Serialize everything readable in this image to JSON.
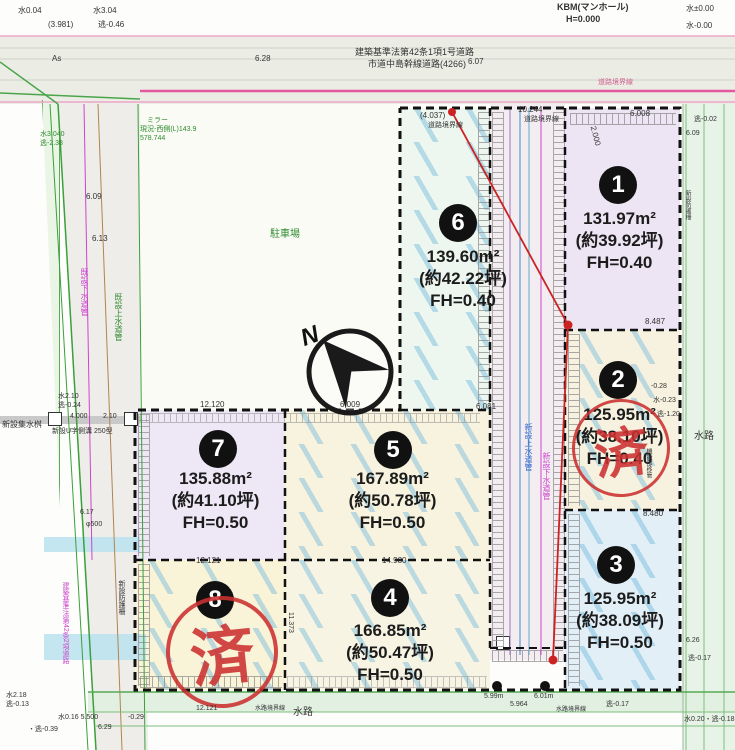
{
  "labels": {
    "north": "N",
    "sold_stamp": "済"
  },
  "plots": [
    {
      "no": "1",
      "area": "131.97m²",
      "tsubo": "(約39.92坪)",
      "fh": "FH=0.40",
      "sold": false
    },
    {
      "no": "2",
      "area": "125.95m²",
      "tsubo": "(約38.10坪)",
      "fh": "FH=0.40",
      "sold": true
    },
    {
      "no": "3",
      "area": "125.95m²",
      "tsubo": "(約38.09坪)",
      "fh": "FH=0.50",
      "sold": false
    },
    {
      "no": "4",
      "area": "166.85m²",
      "tsubo": "(約50.47坪)",
      "fh": "FH=0.50",
      "sold": false
    },
    {
      "no": "5",
      "area": "167.89m²",
      "tsubo": "(約50.78坪)",
      "fh": "FH=0.50",
      "sold": false
    },
    {
      "no": "6",
      "area": "139.60m²",
      "tsubo": "(約42.22坪)",
      "fh": "FH=0.40",
      "sold": false
    },
    {
      "no": "7",
      "area": "135.88m²",
      "tsubo": "(約41.10坪)",
      "fh": "FH=0.50",
      "sold": false
    },
    {
      "no": "8",
      "area": "",
      "tsubo": "",
      "fh": "",
      "sold": true
    }
  ],
  "annotations": [
    {
      "x": 18,
      "y": 7,
      "t": "水0.04"
    },
    {
      "x": 93,
      "y": 7,
      "t": "水3.04"
    },
    {
      "x": 48,
      "y": 21,
      "t": "(3.981)"
    },
    {
      "x": 98,
      "y": 21,
      "t": "逃-0.46"
    },
    {
      "x": 557,
      "y": 3,
      "t": "KBM(マンホール)",
      "s": 9,
      "b": 1
    },
    {
      "x": 566,
      "y": 15,
      "t": "H=0.000",
      "s": 9,
      "b": 1
    },
    {
      "x": 686,
      "y": 5,
      "t": "水±0.00"
    },
    {
      "x": 686,
      "y": 22,
      "t": "水-0.00"
    },
    {
      "x": 52,
      "y": 55,
      "t": "As"
    },
    {
      "x": 255,
      "y": 55,
      "t": "6.28"
    },
    {
      "x": 355,
      "y": 48,
      "t": "建築基準法第42条1項1号道路",
      "s": 9
    },
    {
      "x": 368,
      "y": 60,
      "t": "市道中島幹線道路(4266)",
      "s": 9
    },
    {
      "x": 468,
      "y": 58,
      "t": "6.07"
    },
    {
      "x": 598,
      "y": 79,
      "t": "道路境界線",
      "s": 7,
      "c": "p"
    },
    {
      "x": 147,
      "y": 117,
      "t": "ミラー",
      "c": "g",
      "s": 7
    },
    {
      "x": 140,
      "y": 126,
      "t": "現況-西側(L)143.9",
      "c": "g",
      "s": 7
    },
    {
      "x": 140,
      "y": 135,
      "t": "578.744",
      "c": "g",
      "s": 7
    },
    {
      "x": 270,
      "y": 230,
      "t": "駐車場",
      "c": "g",
      "s": 10
    },
    {
      "x": 694,
      "y": 116,
      "t": "逃-0.02",
      "s": 7
    },
    {
      "x": 686,
      "y": 130,
      "t": "6.09",
      "s": 7
    },
    {
      "x": 420,
      "y": 112,
      "t": "(4.037)"
    },
    {
      "x": 428,
      "y": 122,
      "t": "道路境界線",
      "s": 7
    },
    {
      "x": 518,
      "y": 106,
      "t": "10.244"
    },
    {
      "x": 524,
      "y": 116,
      "t": "道路境界線",
      "s": 7
    },
    {
      "x": 630,
      "y": 110,
      "t": "6.008"
    },
    {
      "x": 585,
      "y": 132,
      "t": "2.000",
      "r": 75
    },
    {
      "x": 645,
      "y": 318,
      "t": "8.487"
    },
    {
      "x": 643,
      "y": 510,
      "t": "8.480"
    },
    {
      "x": 200,
      "y": 401,
      "t": "12.120"
    },
    {
      "x": 340,
      "y": 401,
      "t": "6.009"
    },
    {
      "x": 476,
      "y": 403,
      "t": "6.081"
    },
    {
      "x": 196,
      "y": 557,
      "t": "12.121"
    },
    {
      "x": 382,
      "y": 557,
      "t": "14.980"
    },
    {
      "x": 287,
      "y": 612,
      "t": "11.373",
      "v": 1,
      "s": 7
    },
    {
      "x": 40,
      "y": 131,
      "t": "水3.040",
      "c": "g",
      "s": 7
    },
    {
      "x": 40,
      "y": 140,
      "t": "逃-2.38",
      "c": "g",
      "s": 7
    },
    {
      "x": 86,
      "y": 193,
      "t": "6.09"
    },
    {
      "x": 92,
      "y": 235,
      "t": "6.13"
    },
    {
      "x": 80,
      "y": 268,
      "t": "既設下水道管",
      "c": "m",
      "s": 8,
      "v": 1
    },
    {
      "x": 114,
      "y": 293,
      "t": "既設上水道管",
      "c": "g",
      "s": 8,
      "v": 1
    },
    {
      "x": 58,
      "y": 393,
      "t": "水2.10",
      "s": 7
    },
    {
      "x": 58,
      "y": 402,
      "t": "逃-0.24",
      "s": 7
    },
    {
      "x": 70,
      "y": 413,
      "t": "4.000",
      "s": 7
    },
    {
      "x": 103,
      "y": 413,
      "t": "2.10",
      "s": 7
    },
    {
      "x": 2,
      "y": 421,
      "t": "新設集水桝",
      "s": 8
    },
    {
      "x": 52,
      "y": 428,
      "t": "新設U字側溝 250型",
      "s": 7
    },
    {
      "x": 80,
      "y": 509,
      "t": "6.17",
      "s": 7
    },
    {
      "x": 86,
      "y": 521,
      "t": "φ500",
      "s": 7
    },
    {
      "x": 62,
      "y": 582,
      "t": "建築基準法第42条2項道路",
      "c": "m",
      "s": 7,
      "v": 1
    },
    {
      "x": 118,
      "y": 580,
      "t": "新設防護柵",
      "s": 7,
      "v": 1
    },
    {
      "x": 524,
      "y": 423,
      "t": "新設上水道管",
      "c": "b",
      "s": 8,
      "v": 1
    },
    {
      "x": 542,
      "y": 452,
      "t": "新設下水道管",
      "c": "m",
      "s": 8,
      "v": 1
    },
    {
      "x": 645,
      "y": 448,
      "t": "機能部移管",
      "s": 6,
      "v": 1
    },
    {
      "x": 684,
      "y": 190,
      "t": "新設防護柵",
      "s": 6,
      "v": 1
    },
    {
      "x": 651,
      "y": 383,
      "t": "-0.28",
      "s": 7
    },
    {
      "x": 653,
      "y": 397,
      "t": "水-0.23",
      "s": 7
    },
    {
      "x": 657,
      "y": 411,
      "t": "逃-1.20",
      "s": 7
    },
    {
      "x": 694,
      "y": 432,
      "t": "水路",
      "s": 10
    },
    {
      "x": 686,
      "y": 637,
      "t": "6.26",
      "s": 7
    },
    {
      "x": 688,
      "y": 655,
      "t": "逃-0.17",
      "s": 7
    },
    {
      "x": 196,
      "y": 705,
      "t": "12.121",
      "s": 7
    },
    {
      "x": 255,
      "y": 706,
      "t": "水路境界線",
      "s": 6
    },
    {
      "x": 293,
      "y": 708,
      "t": "水路",
      "s": 10
    },
    {
      "x": 510,
      "y": 701,
      "t": "5.964",
      "s": 7
    },
    {
      "x": 556,
      "y": 707,
      "t": "水路境界線",
      "s": 6
    },
    {
      "x": 606,
      "y": 701,
      "t": "逃-0.17",
      "s": 7
    },
    {
      "x": 6,
      "y": 692,
      "t": "水2.18",
      "s": 7
    },
    {
      "x": 6,
      "y": 701,
      "t": "逃-0.13",
      "s": 7
    },
    {
      "x": 58,
      "y": 714,
      "t": "水0.16 5.500",
      "s": 7
    },
    {
      "x": 128,
      "y": 714,
      "t": "-0.29",
      "s": 7
    },
    {
      "x": 28,
      "y": 726,
      "t": "・逃-0.39",
      "s": 7
    },
    {
      "x": 98,
      "y": 724,
      "t": "6.29",
      "s": 7
    },
    {
      "x": 684,
      "y": 716,
      "t": "水0.20・逃-0.18",
      "s": 7
    },
    {
      "x": 484,
      "y": 693,
      "t": "5.99m",
      "s": 7
    },
    {
      "x": 534,
      "y": 693,
      "t": "6.01m",
      "s": 7
    }
  ]
}
